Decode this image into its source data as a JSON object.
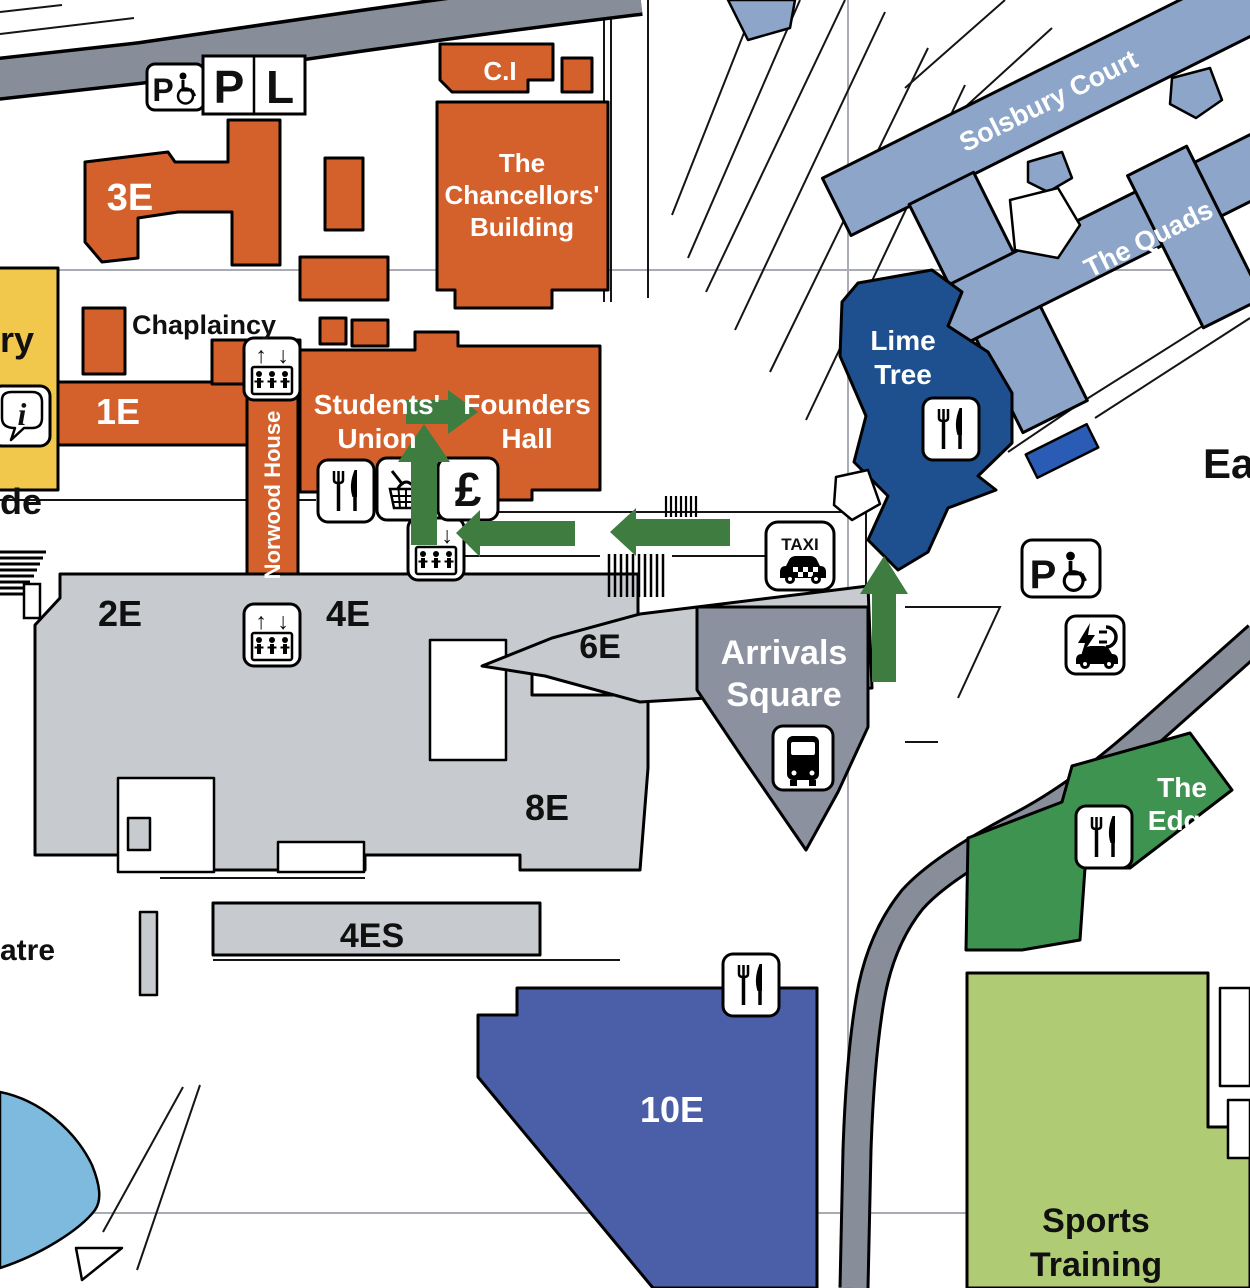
{
  "map_name": "campus-map-east",
  "colors": {
    "orange": "#D4612C",
    "yellow": "#F1C84B",
    "building_gray": "#C7CBCF",
    "dark_gray": "#8C91A0",
    "road_gray": "#888E99",
    "light_blue": "#8CA5C9",
    "dark_blue": "#1E4F8E",
    "medium_blue": "#4A5FA8",
    "accent_blue": "#2B5CB5",
    "green": "#3F9351",
    "light_green": "#AFCB74",
    "pond_blue": "#7EB9DE",
    "arrow_green": "#3E7C40",
    "grid_gray": "#A9ADB3"
  },
  "labels": {
    "b3e": "3E",
    "ci": "C.I",
    "chancellors": [
      "The",
      "Chancellors'",
      "Building"
    ],
    "chaplaincy": "Chaplaincy",
    "b1e": "1E",
    "norwood": "Norwood House",
    "students_union": [
      "Students'",
      "Union"
    ],
    "founders": [
      "Founders",
      "Hall"
    ],
    "solsbury": "Solsbury Court",
    "quads": "The Quads",
    "lime": [
      "Lime",
      "Tree"
    ],
    "b2e": "2E",
    "b4e": "4E",
    "b6e": "6E",
    "b8e": "8E",
    "b4es": "4ES",
    "arrivals": [
      "Arrivals",
      "Square"
    ],
    "b10e": "10E",
    "edge": [
      "The",
      "Edge"
    ],
    "sports": [
      "Sports",
      "Training"
    ],
    "east": "East",
    "partial_ry": "ry",
    "partial_de": "de",
    "partial_atre": "atre"
  },
  "icons": {
    "parking": "P",
    "accessible_parking": "P",
    "loading_bay": "L",
    "taxi": "TAXI",
    "pound": "£",
    "info": "i",
    "lift_up": "↑",
    "lift_down": "↓"
  }
}
